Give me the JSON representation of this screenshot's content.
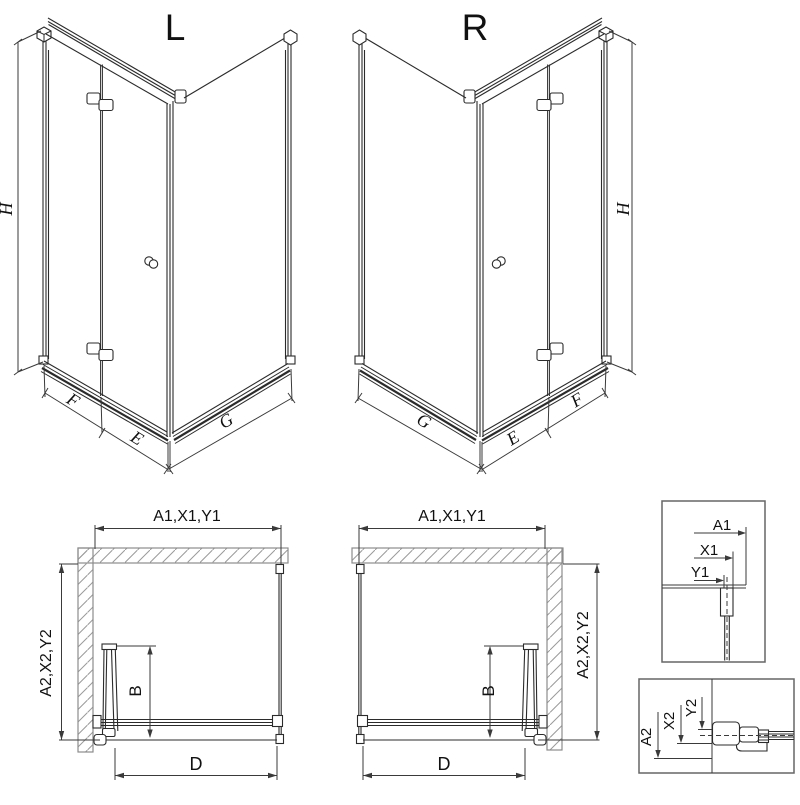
{
  "colors": {
    "background": "#ffffff",
    "line": "#2b2b2b",
    "dim_line": "#3a3a3a",
    "wall_outline": "#8c8c8c",
    "hatch": "#9a9a9a",
    "text": "#111111"
  },
  "iso_left": {
    "title": "L",
    "height_label": "H",
    "front_fixed_label": "F",
    "front_door_label": "E",
    "side_panel_label": "G"
  },
  "iso_right": {
    "title": "R",
    "height_label": "H",
    "front_fixed_label": "F",
    "front_door_label": "E",
    "side_panel_label": "G"
  },
  "plan_left": {
    "width_label": "A1,X1,Y1",
    "depth_label": "A2,X2,Y2",
    "fold_label": "B",
    "entry_label": "D"
  },
  "plan_right": {
    "width_label": "A1,X1,Y1",
    "depth_label": "A2,X2,Y2",
    "fold_label": "B",
    "entry_label": "D"
  },
  "detail_width": {
    "labels": [
      "A1",
      "X1",
      "Y1"
    ]
  },
  "detail_depth": {
    "labels": [
      "A2",
      "X2",
      "Y2"
    ]
  }
}
